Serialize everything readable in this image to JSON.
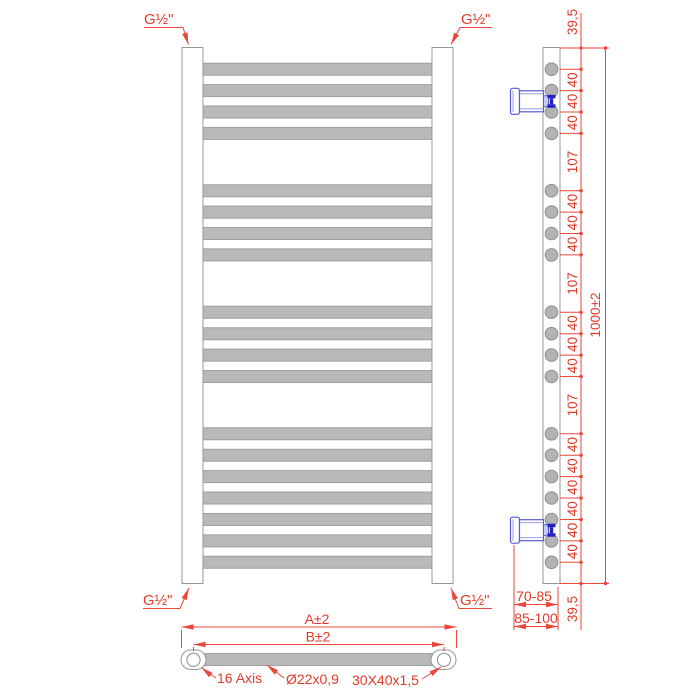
{
  "drawing": {
    "type": "technical-drawing",
    "subject": "heated towel rail radiator, front / side / bottom orthographic views",
    "units": "mm"
  },
  "labels": {
    "g_half": "G½\""
  },
  "side_view": {
    "overall": "1000±2",
    "chain_dims": [
      "39,5",
      "40",
      "40",
      "40",
      "107",
      "40",
      "40",
      "40",
      "107",
      "40",
      "40",
      "40",
      "107",
      "40",
      "40",
      "40",
      "40",
      "40",
      "40",
      "39,5"
    ],
    "depth_dims": [
      "70-85",
      "85-100"
    ]
  },
  "bottom_view": {
    "overall_width": "A±2",
    "axis_distance": "B±2",
    "axis_note": "16 Axis",
    "tube_note": "Ø22x0,9",
    "profile_note": "30X40x1,5"
  },
  "colors": {
    "dimension_red": "#e23a28",
    "bracket_blue": "#5a5ad2",
    "bracket_dark_blue": "#2222c4",
    "tube_gray": "#b9b9b9",
    "outline_gray": "#979797"
  }
}
